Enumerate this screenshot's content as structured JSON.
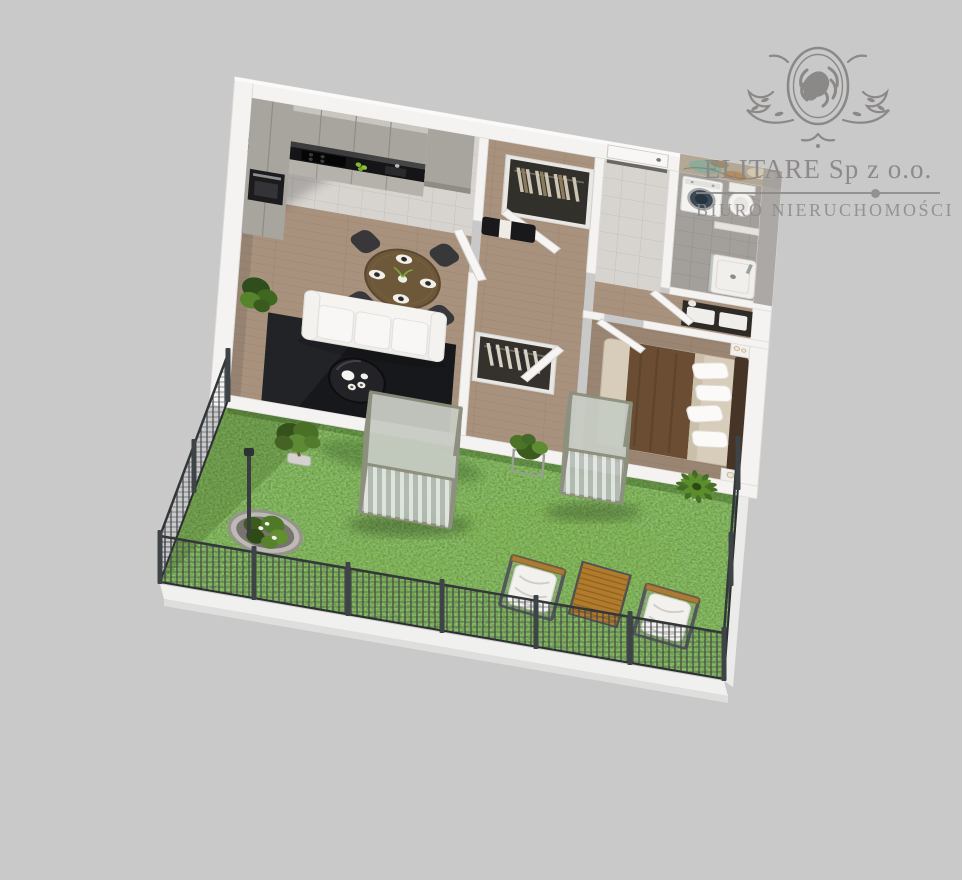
{
  "watermark": {
    "company": "ELITARE Sp z o.o.",
    "subtitle": "BIURO NIERUCHOMOŚCI"
  },
  "colors": {
    "background": "#c9c9c9",
    "wall": "#f4f3f1",
    "wood": "#a8927e",
    "tile": "#d7d4d0",
    "bathtile": "#a3a09c",
    "cabinet": "#a8a49e",
    "counter": "#151517",
    "rug": "#17181b",
    "sofa": "#efedea",
    "diningwood": "#6d5839",
    "bedblanket": "#6b4d34",
    "bedsheet": "#d8cdbb",
    "grass": "#4f7426",
    "fence": "#3e4347",
    "glassframe": "#8d907e",
    "glass": "#b6bdb7",
    "deck": "#b07b2c",
    "marblebase": "#b3a895",
    "marbleteal": "#7fae9c",
    "marblerust": "#b47a45",
    "logo": "#8b8987"
  }
}
